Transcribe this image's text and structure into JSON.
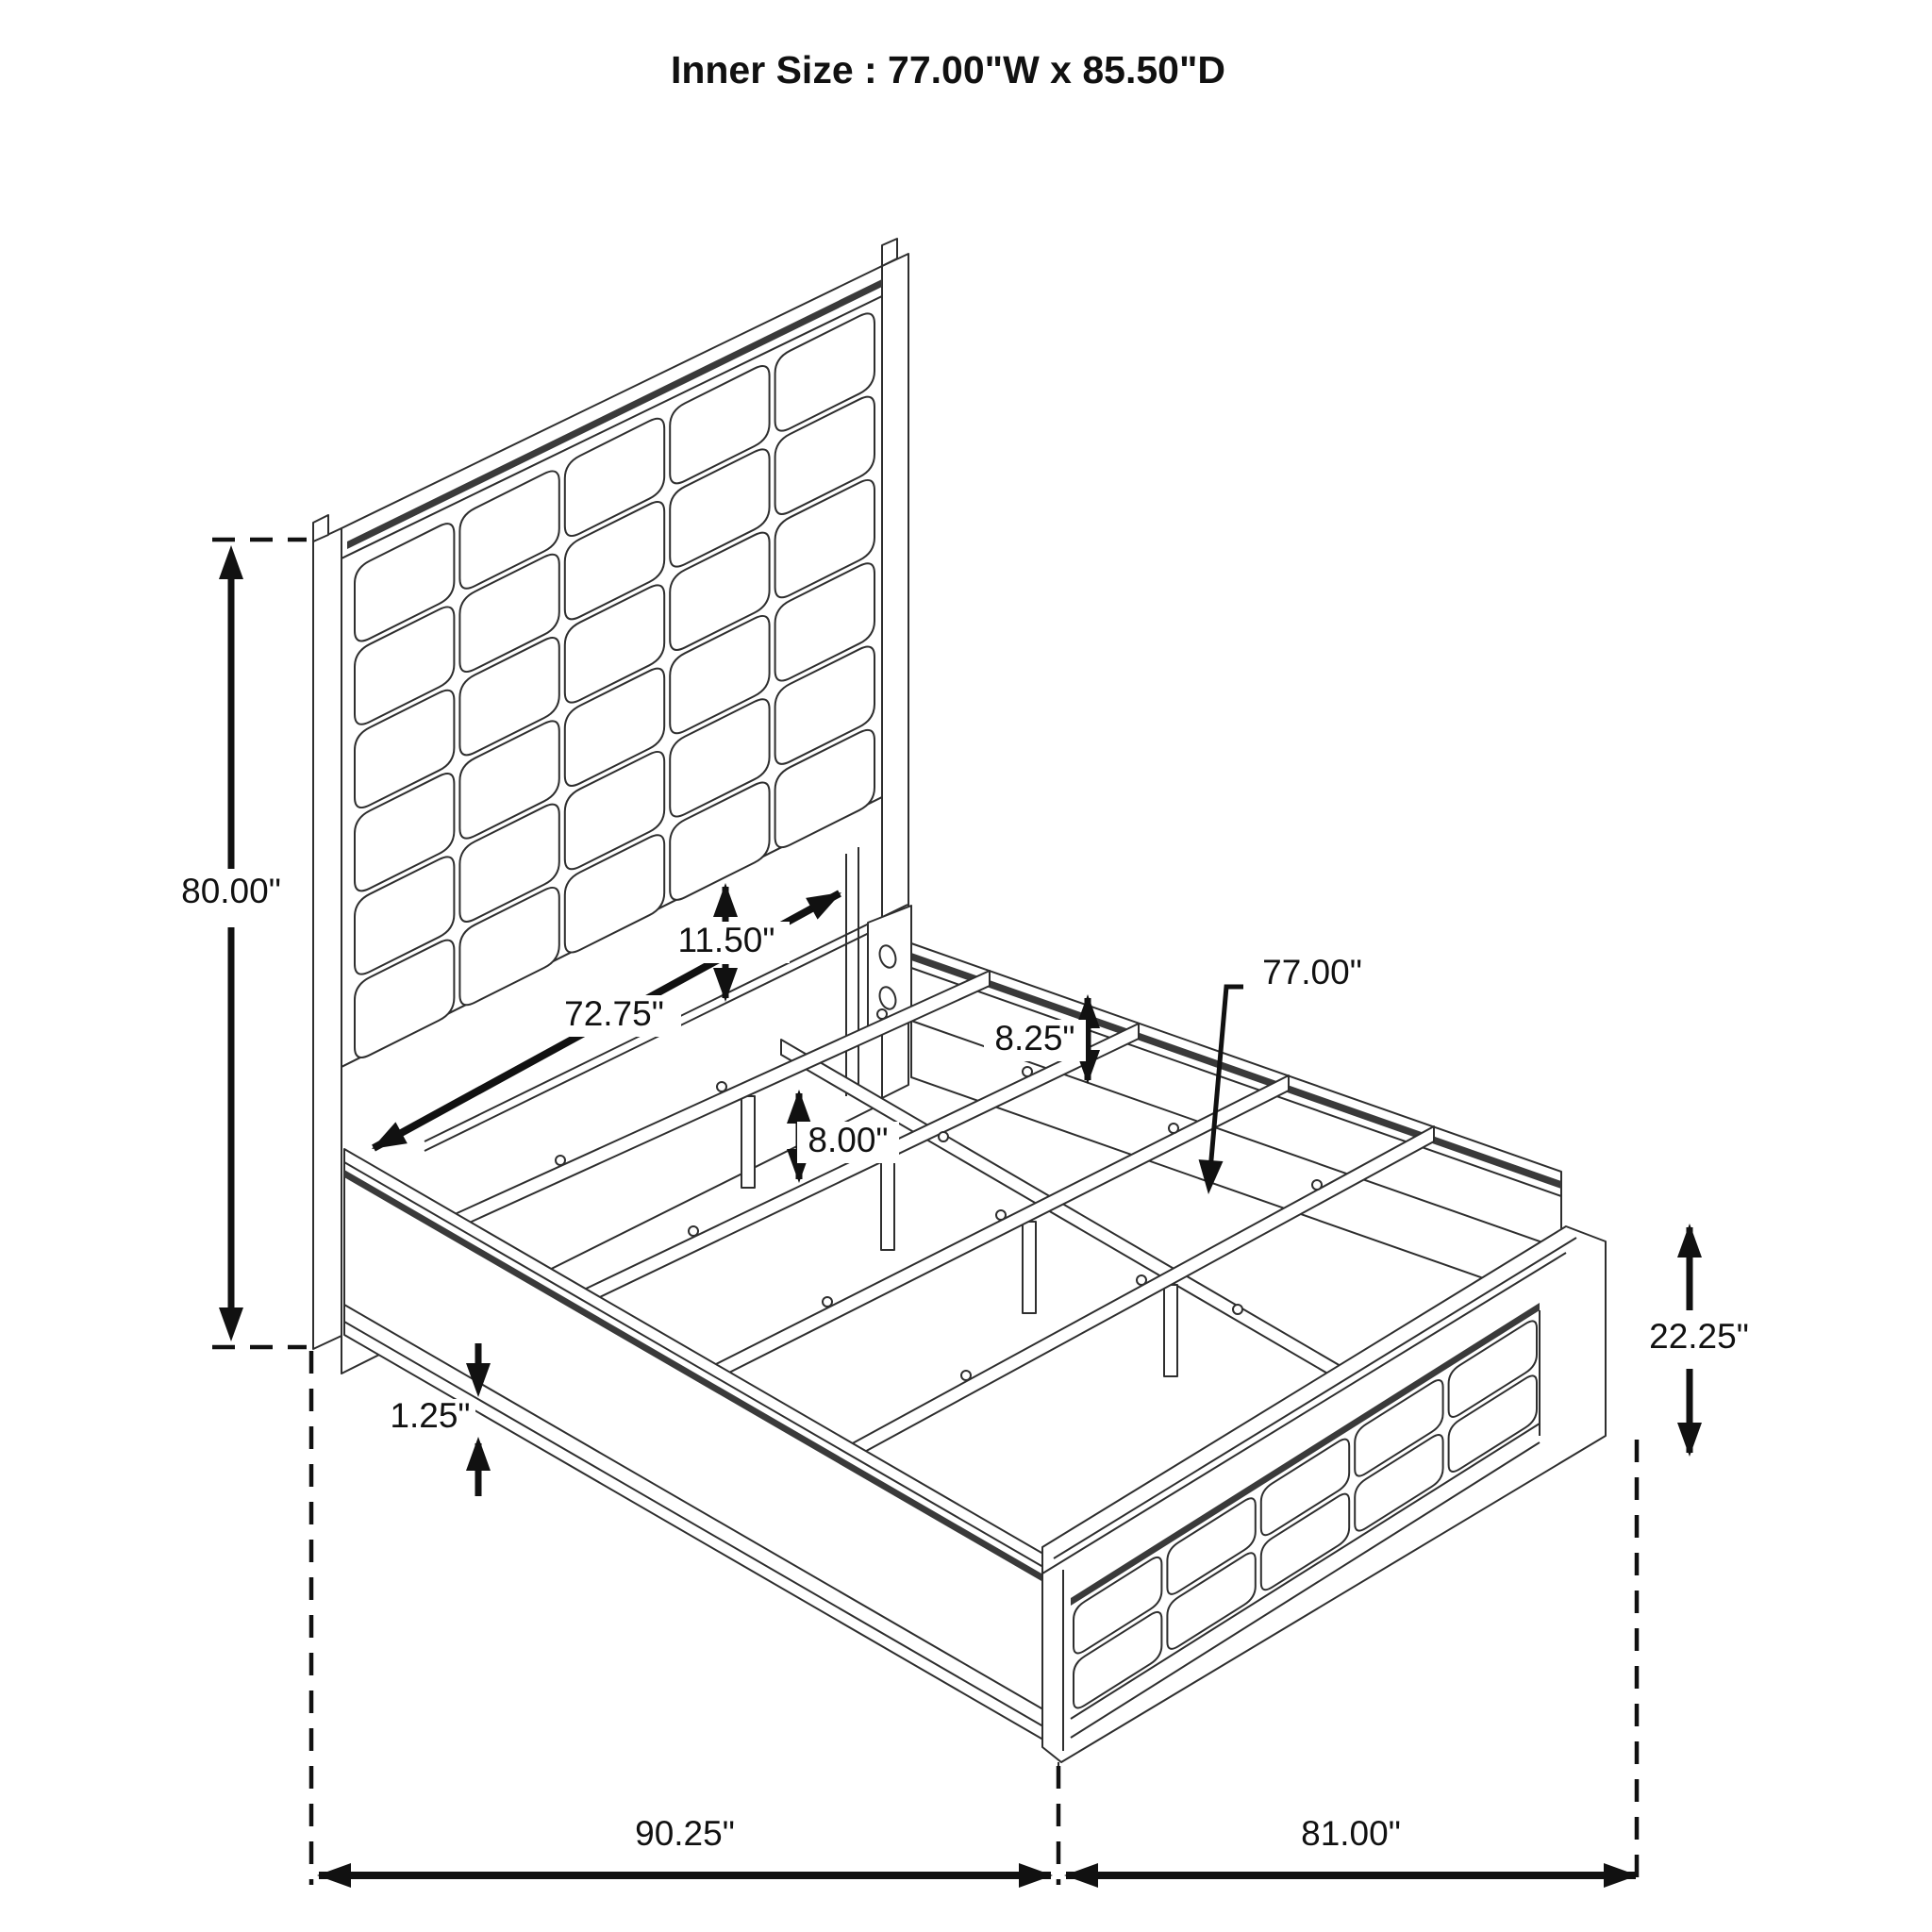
{
  "title": "Inner Size : 77.00\"W x 85.50\"D",
  "inner_size": {
    "width": "77.00\"",
    "depth": "85.50\""
  },
  "dimensions": {
    "overall_height": "80.00\"",
    "panel_to_rail_gap": "11.50\"",
    "headboard_inner_span": "72.75\"",
    "side_rail_height": "8.25\"",
    "support_leg_height": "8.00\"",
    "slat_length": "77.00\"",
    "base_trim_height": "1.25\"",
    "footboard_height": "22.25\"",
    "overall_depth": "90.25\"",
    "overall_width": "81.00\""
  },
  "colors": {
    "line": "#2e2e2e",
    "dim": "#111111",
    "cap_band": "#3a3a3a",
    "background": "#ffffff"
  }
}
